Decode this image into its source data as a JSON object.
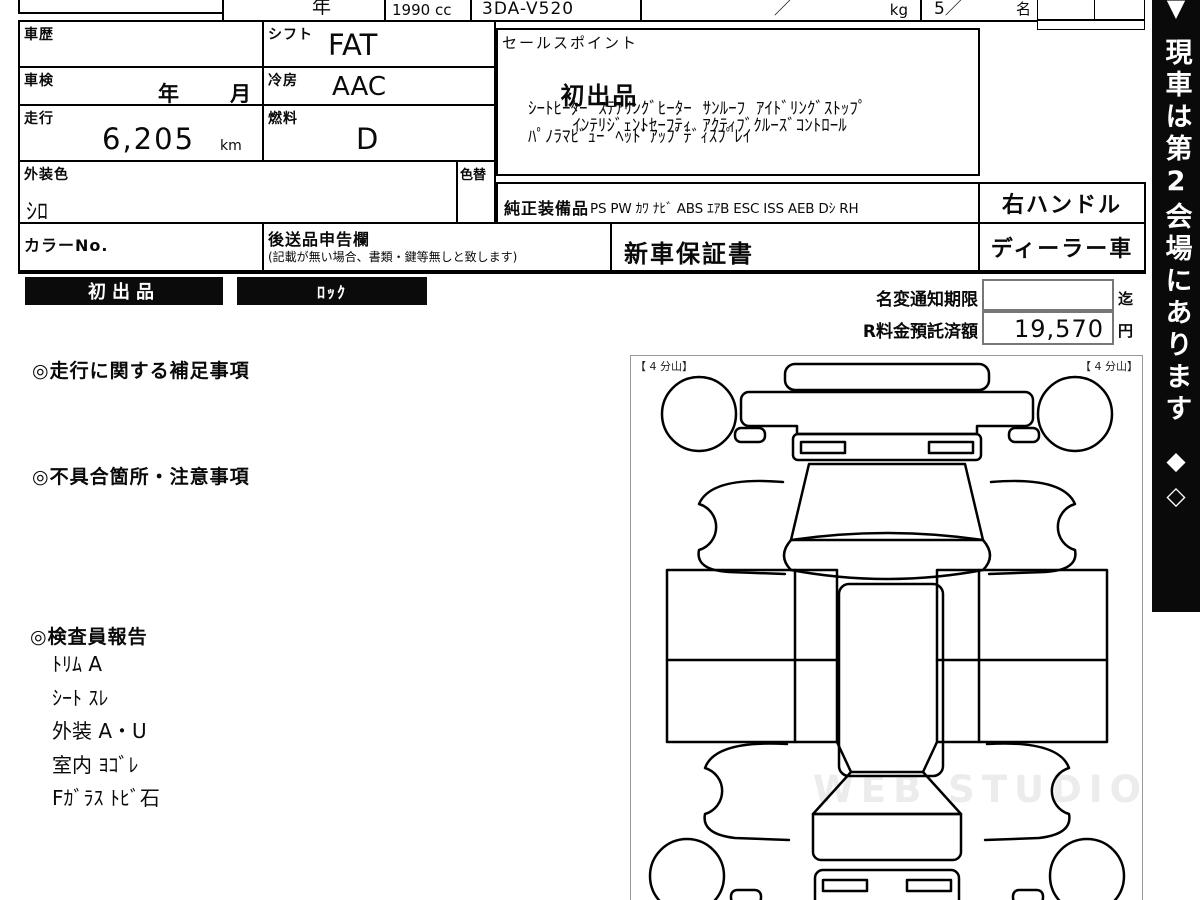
{
  "top_row": {
    "year_label": "年",
    "displacement": "1990 cc",
    "model_code": "3DA-V520",
    "weight_slash": "／",
    "weight_unit": "kg",
    "capacity_value": "5／",
    "capacity_unit": "名"
  },
  "table": {
    "history_label": "車歴",
    "shift_label": "シフト",
    "shift_value": "FAT",
    "inspection_label": "車検",
    "inspection_year": "年",
    "inspection_month": "月",
    "ac_label": "冷房",
    "ac_value": "AAC",
    "mileage_label": "走行",
    "mileage_value": "6,205",
    "mileage_unit": "km",
    "fuel_label": "燃料",
    "fuel_value": "D",
    "ext_color_label": "外装色",
    "ext_color_value": "ｼﾛ",
    "color_change_label": "色替",
    "color_no_label": "カラーNo.",
    "later_items_label": "後送品申告欄",
    "later_items_note": "(記載が無い場合、書類・鍵等無しと致します)",
    "warranty_value": "新車保証書",
    "equipment_label": "純正装備品",
    "equipment_value": "PS PW ｶﾜ ﾅﾋﾞ ABS ｴｱB ESC ISS AEB Dｼ RH",
    "handle_value": "右ハンドル",
    "dealer_value": "ディーラー車"
  },
  "sales_point": {
    "label": "セールスポイント",
    "line1_big": "初出品",
    "line1_rest": "ｲﾝﾃﾘｼﾞｪﾝﾄｾｰﾌﾃｨ  ｱｸﾃｨﾌﾞｸﾙｰｽﾞｺﾝﾄﾛｰﾙ",
    "line2": "ｼｰﾄﾋｰﾀｰ  ｽﾃｱﾘﾝｸﾞﾋｰﾀｰ  ｻﾝﾙｰﾌ  ｱｲﾄﾞﾘﾝｸﾞｽﾄｯﾌﾟ",
    "line3": "ﾊﾟﾉﾗﾏﾋﾞｭｰ  ﾍｯﾄﾞｱｯﾌﾟﾃﾞｨｽﾌﾟﾚｲ"
  },
  "badges": {
    "first_listing": "初出品",
    "lock": "ﾛｯｸ"
  },
  "notice": {
    "name_change_label": "名変通知期限",
    "name_change_value": "",
    "name_change_suffix": "迄",
    "deposit_label": "R料金預託済額",
    "deposit_value": "19,570",
    "deposit_unit": "円"
  },
  "sections": {
    "mileage_notes": "◎走行に関する補足事項",
    "defect_notes": "◎不具合箇所・注意事項",
    "inspector_report": "◎検査員報告",
    "report_items": [
      "ﾄﾘﾑ A",
      "ｼｰﾄ ｽﾚ",
      "外装 A・U",
      "室内 ﾖｺﾞﾚ",
      "Fｶﾞﾗｽ ﾄﾋﾞ石"
    ]
  },
  "diagram": {
    "tire_label_left": "【 4 分山】",
    "tire_label_right": "【 4 分山】",
    "watermark": "WEB STUDIO PRO"
  },
  "side_banner": {
    "top_icon": "▼",
    "text": "現車は第2会場にあります",
    "bottom_icons": "◆◇"
  },
  "colors": {
    "ink": "#0a0a0a",
    "banner_bg": "#0a0a0a",
    "watermark": "#ececec",
    "box_border": "#777777"
  }
}
